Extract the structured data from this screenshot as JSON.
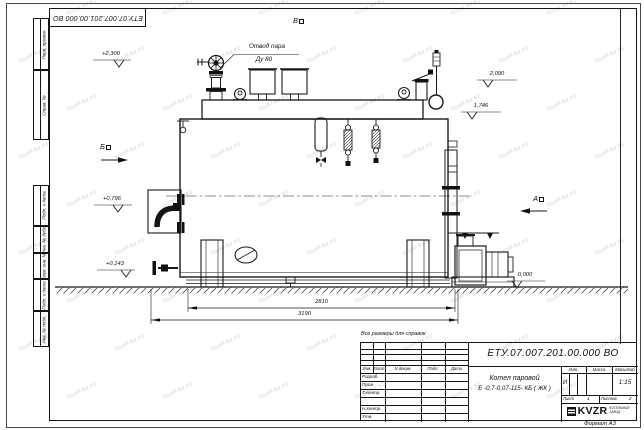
{
  "watermark": "kotel-kv.kz",
  "sheet": {
    "top_stamp": "ЕТУ.07.007.201.00.000  ВО",
    "left_column_labels": [
      "Перв. примен.",
      "Справ. №",
      "Подп. и дата",
      "Инв. № дубл.",
      "Взам. инв. №",
      "Подп. и дата",
      "Инв. № подл."
    ],
    "reference_note": "Все размеры для справок",
    "format_note": "Формат  А3"
  },
  "drawing": {
    "steam_outlet_label": "Отвод пара",
    "steam_outlet_dn": "Ду 80",
    "view_marks": {
      "top": "В",
      "left": "Б",
      "right": "А"
    },
    "elevations": {
      "plus2300": "+2,300",
      "v2090": "2,090",
      "v1746": "1,746",
      "plus0796": "+0,796",
      "plus0143": "+0,143",
      "zero": "0,000"
    },
    "dimensions": {
      "width_inner": "2810",
      "width_total": "3190"
    }
  },
  "title_block": {
    "doc_number": "ЕТУ.07.007.201.00.000  ВО",
    "name_line1": "Котел паровой",
    "name_line2": "Е -0,7-0,07-115- КБ ( ЖК )",
    "cols": {
      "izm": "Изм.",
      "list": "Лист",
      "ndoc": "N докум.",
      "podp": "Подп.",
      "data": "Дата"
    },
    "roles": [
      "Разраб.",
      "Пров.",
      "Т.контр.",
      "",
      "Н.контр.",
      "Утв."
    ],
    "lit_label": "Лит.",
    "mass_label": "Масса",
    "scale_label": "Масштаб",
    "lit_value": "И",
    "scale_value": "1:15",
    "sheet_label": "Лист",
    "sheet_value": "1",
    "sheets_label": "Листов",
    "sheets_value": "2",
    "logo_text": "KVZR",
    "company_line1": "КОТЕЛЬНЫЙ",
    "company_line2": "ЗАВОД"
  }
}
